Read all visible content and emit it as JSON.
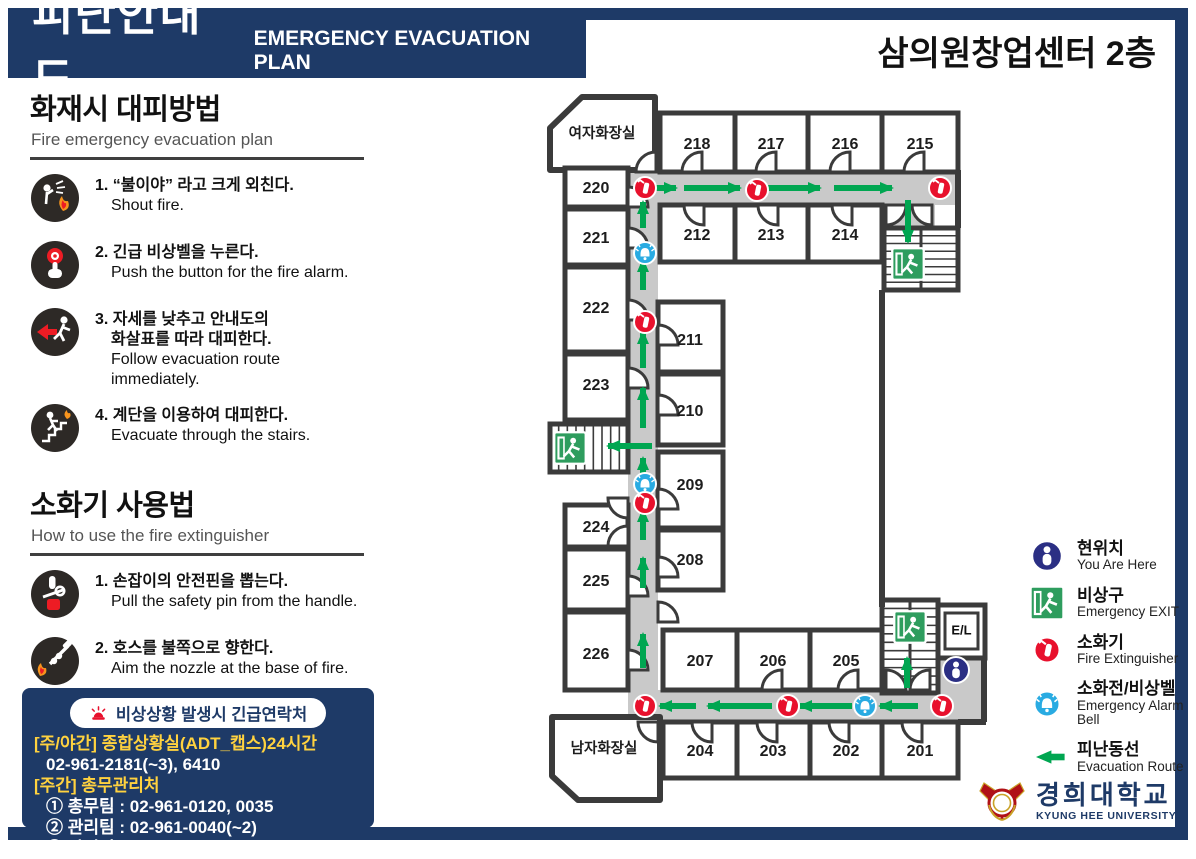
{
  "header": {
    "title_ko": "피난안내도",
    "title_en": "EMERGENCY EVACUATION PLAN",
    "building": "삼의원창업센터 2층"
  },
  "colors": {
    "navy": "#1e3a67",
    "arrow_green": "#00a651",
    "exit_green": "#2e9d5e",
    "ext_red": "#e8112d",
    "bell_blue": "#29abe2",
    "here_navy": "#2b2f84",
    "corridor_gray": "#c9c9c9",
    "wall": "#3b3b3b",
    "contact_yellow": "#ffd23f",
    "logo_red": "#b01116",
    "logo_gold": "#c9a227"
  },
  "sections": [
    {
      "name": "fire-evacuation",
      "title": "화재시 대피방법",
      "subtitle": "Fire emergency evacuation plan",
      "steps": [
        {
          "icon": "shout-fire",
          "lines_ko": [
            "1. “불이야” 라고 크게 외친다."
          ],
          "lines_en": [
            "Shout fire."
          ]
        },
        {
          "icon": "press-alarm",
          "lines_ko": [
            "2. 긴급 비상벨을 누른다."
          ],
          "lines_en": [
            "Push the button for the fire alarm."
          ]
        },
        {
          "icon": "follow-route",
          "lines_ko": [
            "3. 자세를 낮추고 안내도의",
            "화살표를 따라 대피한다."
          ],
          "lines_en": [
            "Follow evacuation route immediately."
          ]
        },
        {
          "icon": "use-stairs",
          "lines_ko": [
            "4. 계단을 이용하여 대피한다."
          ],
          "lines_en": [
            "Evacuate through the stairs."
          ]
        }
      ]
    },
    {
      "name": "fire-extinguisher",
      "title": "소화기 사용법",
      "subtitle": "How to use the fire extinguisher",
      "steps": [
        {
          "icon": "pull-pin",
          "lines_ko": [
            "1. 손잡이의 안전핀을 뽑는다."
          ],
          "lines_en": [
            "Pull the safety pin from the handle."
          ]
        },
        {
          "icon": "aim-nozzle",
          "lines_ko": [
            "2. 호스를 불쪽으로 향한다."
          ],
          "lines_en": [
            "Aim the nozzle at the base of fire."
          ]
        },
        {
          "icon": "squeeze-handle",
          "lines_ko": [
            "3. 손잡이를 눌러 골고루 분사한다."
          ],
          "lines_en": [
            "Squeeze the handle and",
            "sweep the nozzle from side to side."
          ]
        }
      ]
    }
  ],
  "contact": {
    "title": "비상상황 발생시 긴급연락처",
    "lines": [
      {
        "text": "[주/야간] 종합상황실(ADT_캡스)24시간",
        "color": "y",
        "indent": false
      },
      {
        "text": "02-961-2181(~3), 6410",
        "color": "w",
        "indent": true
      },
      {
        "text": "[주간] 총무관리처",
        "color": "y",
        "indent": false
      },
      {
        "text": "① 총무팀 : 02-961-0120, 0035",
        "color": "w",
        "indent": true
      },
      {
        "text": "② 관리팀 : 02-961-0040(~2)",
        "color": "w",
        "indent": true
      },
      {
        "text": "③ 안전팀 : 02-961-0119",
        "color": "w",
        "indent": true
      }
    ]
  },
  "legend": {
    "items": [
      {
        "icon": "here",
        "ko": "현위치",
        "en": "You Are Here"
      },
      {
        "icon": "exit",
        "ko": "비상구",
        "en": "Emergency EXIT"
      },
      {
        "icon": "ext",
        "ko": "소화기",
        "en": "Fire Extinguisher"
      },
      {
        "icon": "bell",
        "ko": "소화전/비상벨",
        "en": "Emergency Alarm Bell"
      },
      {
        "icon": "route",
        "ko": "피난동선",
        "en": "Evacuation Route"
      }
    ]
  },
  "logo": {
    "ko": "경희대학교",
    "en": "KYUNG HEE UNIVERSITY"
  },
  "floor_plan": {
    "elevator_label": "E/L",
    "corridors": [
      [
        628,
        172,
        330,
        33
      ],
      [
        628,
        172,
        30,
        548
      ],
      [
        628,
        690,
        354,
        30
      ],
      [
        938,
        658,
        44,
        34
      ],
      [
        884,
        205,
        51,
        24
      ]
    ],
    "rooms": [
      {
        "label": "여자화장실",
        "poly": [
          [
            550,
            128
          ],
          [
            582,
            97
          ],
          [
            655,
            97
          ],
          [
            655,
            170
          ],
          [
            550,
            170
          ]
        ],
        "lx": 602,
        "ly": 133,
        "fs": 14.5
      },
      {
        "label": "220",
        "x": 565,
        "y": 168,
        "w": 63,
        "h": 39,
        "lx": 596,
        "ly": 188
      },
      {
        "label": "221",
        "x": 565,
        "y": 209,
        "w": 63,
        "h": 56,
        "lx": 596,
        "ly": 238
      },
      {
        "label": "222",
        "x": 565,
        "y": 267,
        "w": 63,
        "h": 85,
        "lx": 596,
        "ly": 308
      },
      {
        "label": "223",
        "x": 565,
        "y": 354,
        "w": 63,
        "h": 66,
        "lx": 596,
        "ly": 385
      },
      {
        "label": "224",
        "x": 565,
        "y": 505,
        "w": 63,
        "h": 42,
        "lx": 596,
        "ly": 527
      },
      {
        "label": "225",
        "x": 565,
        "y": 549,
        "w": 63,
        "h": 61,
        "lx": 596,
        "ly": 581
      },
      {
        "label": "226",
        "x": 565,
        "y": 612,
        "w": 63,
        "h": 78,
        "lx": 596,
        "ly": 654
      },
      {
        "label": "218",
        "x": 660,
        "y": 113,
        "w": 75,
        "h": 59,
        "lx": 697,
        "ly": 144
      },
      {
        "label": "217",
        "x": 735,
        "y": 113,
        "w": 73,
        "h": 59,
        "lx": 771,
        "ly": 144
      },
      {
        "label": "216",
        "x": 808,
        "y": 113,
        "w": 74,
        "h": 59,
        "lx": 845,
        "ly": 144
      },
      {
        "label": "215",
        "x": 882,
        "y": 113,
        "w": 76,
        "h": 59,
        "lx": 920,
        "ly": 144
      },
      {
        "label": "212",
        "x": 660,
        "y": 205,
        "w": 75,
        "h": 57,
        "lx": 697,
        "ly": 235
      },
      {
        "label": "213",
        "x": 735,
        "y": 205,
        "w": 73,
        "h": 57,
        "lx": 771,
        "ly": 235
      },
      {
        "label": "214",
        "x": 808,
        "y": 205,
        "w": 74,
        "h": 57,
        "lx": 845,
        "ly": 235
      },
      {
        "label": "211",
        "x": 658,
        "y": 302,
        "w": 65,
        "h": 70,
        "lx": 690,
        "ly": 340
      },
      {
        "label": "210",
        "x": 658,
        "y": 374,
        "w": 65,
        "h": 71,
        "lx": 690,
        "ly": 411
      },
      {
        "label": "209",
        "x": 658,
        "y": 452,
        "w": 65,
        "h": 76,
        "lx": 690,
        "ly": 485
      },
      {
        "label": "208",
        "x": 658,
        "y": 530,
        "w": 65,
        "h": 60,
        "lx": 690,
        "ly": 560
      },
      {
        "label": "207",
        "x": 663,
        "y": 630,
        "w": 74,
        "h": 60,
        "lx": 700,
        "ly": 661
      },
      {
        "label": "206",
        "x": 737,
        "y": 630,
        "w": 73,
        "h": 60,
        "lx": 773,
        "ly": 661
      },
      {
        "label": "205",
        "x": 810,
        "y": 630,
        "w": 72,
        "h": 60,
        "lx": 846,
        "ly": 661
      },
      {
        "label": "204",
        "x": 663,
        "y": 722,
        "w": 74,
        "h": 56,
        "lx": 700,
        "ly": 751
      },
      {
        "label": "203",
        "x": 737,
        "y": 722,
        "w": 73,
        "h": 56,
        "lx": 773,
        "ly": 751
      },
      {
        "label": "202",
        "x": 810,
        "y": 722,
        "w": 72,
        "h": 56,
        "lx": 846,
        "ly": 751
      },
      {
        "label": "201",
        "x": 882,
        "y": 722,
        "w": 76,
        "h": 56,
        "lx": 920,
        "ly": 751
      },
      {
        "label": "남자화장실",
        "poly": [
          [
            552,
            717
          ],
          [
            660,
            717
          ],
          [
            660,
            800
          ],
          [
            578,
            800
          ],
          [
            552,
            776
          ]
        ],
        "lx": 604,
        "ly": 748,
        "fs": 14.5
      }
    ],
    "walls": [
      [
        882,
        290,
        882,
        607
      ],
      [
        958,
        170,
        958,
        228
      ],
      [
        984,
        656,
        984,
        722
      ],
      [
        958,
        722,
        986,
        722
      ],
      [
        655,
        97,
        655,
        113
      ]
    ],
    "stairs": [
      {
        "x": 884,
        "y": 228,
        "w": 74,
        "h": 62,
        "d": "v",
        "n": 8,
        "rail": true
      },
      {
        "x": 550,
        "y": 424,
        "w": 78,
        "h": 48,
        "d": "h",
        "n": 9,
        "rail": false
      },
      {
        "x": 882,
        "y": 600,
        "w": 56,
        "h": 93,
        "d": "v",
        "n": 11,
        "rail": true
      }
    ],
    "elevator": {
      "x": 938,
      "y": 605,
      "w": 47,
      "h": 53
    },
    "doors": [
      [
        656,
        172,
        180
      ],
      [
        702,
        172,
        180
      ],
      [
        776,
        172,
        180
      ],
      [
        850,
        172,
        180
      ],
      [
        924,
        172,
        180
      ],
      [
        704,
        205,
        90
      ],
      [
        778,
        205,
        90
      ],
      [
        852,
        205,
        90
      ],
      [
        886,
        205,
        0
      ],
      [
        932,
        205,
        90
      ],
      [
        628,
        207,
        270
      ],
      [
        628,
        248,
        270
      ],
      [
        628,
        320,
        270
      ],
      [
        628,
        388,
        270
      ],
      [
        628,
        596,
        270
      ],
      [
        628,
        670,
        270
      ],
      [
        628,
        498,
        90
      ],
      [
        628,
        546,
        180
      ],
      [
        658,
        345,
        270
      ],
      [
        658,
        415,
        270
      ],
      [
        658,
        509,
        270
      ],
      [
        658,
        577,
        270
      ],
      [
        658,
        622,
        270
      ],
      [
        782,
        690,
        180
      ],
      [
        858,
        690,
        180
      ],
      [
        712,
        722,
        90
      ],
      [
        777,
        722,
        90
      ],
      [
        849,
        722,
        90
      ],
      [
        922,
        722,
        90
      ],
      [
        658,
        722,
        90
      ],
      [
        886,
        690,
        270
      ],
      [
        930,
        690,
        180
      ]
    ],
    "arrows": [
      [
        652,
        188,
        676,
        188
      ],
      [
        684,
        188,
        740,
        188
      ],
      [
        766,
        188,
        820,
        188
      ],
      [
        834,
        188,
        892,
        188
      ],
      [
        908,
        200,
        908,
        242
      ],
      [
        643,
        228,
        643,
        202
      ],
      [
        643,
        290,
        643,
        260
      ],
      [
        643,
        368,
        643,
        332
      ],
      [
        643,
        428,
        643,
        388
      ],
      [
        652,
        446,
        608,
        446
      ],
      [
        643,
        478,
        643,
        458
      ],
      [
        643,
        540,
        643,
        510
      ],
      [
        643,
        588,
        643,
        558
      ],
      [
        643,
        668,
        643,
        634
      ],
      [
        918,
        706,
        880,
        706
      ],
      [
        852,
        706,
        800,
        706
      ],
      [
        772,
        706,
        708,
        706
      ],
      [
        696,
        706,
        660,
        706
      ],
      [
        907,
        688,
        907,
        658
      ]
    ],
    "icons": [
      [
        "ext",
        645,
        188
      ],
      [
        "ext",
        757,
        190
      ],
      [
        "ext",
        940,
        188
      ],
      [
        "bell",
        645,
        253
      ],
      [
        "ext",
        645,
        322
      ],
      [
        "bell",
        645,
        484
      ],
      [
        "ext",
        645,
        503
      ],
      [
        "ext",
        645,
        706
      ],
      [
        "ext",
        788,
        706
      ],
      [
        "bell",
        865,
        706
      ],
      [
        "ext",
        942,
        706
      ],
      [
        "exit",
        570,
        448
      ],
      [
        "exit",
        908,
        264
      ],
      [
        "exit",
        910,
        627
      ],
      [
        "here",
        956,
        670
      ]
    ]
  }
}
